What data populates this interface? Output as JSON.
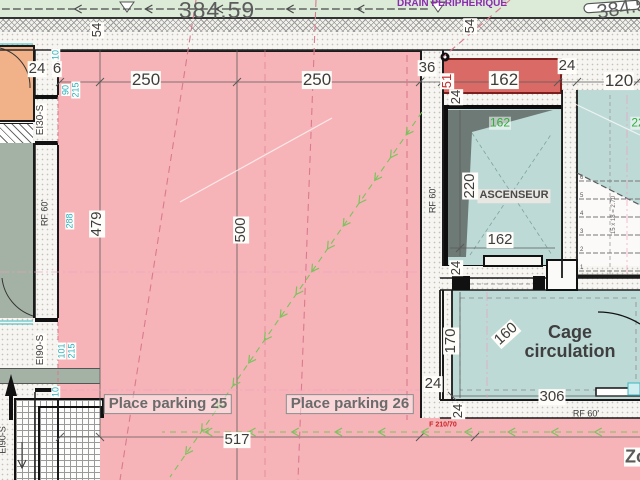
{
  "plan": {
    "levels": {
      "main": "384.59",
      "right": "384.5"
    },
    "drain_label": "DRAIN PÉRIPHÉRIQUE",
    "rooms": {
      "parking25": "Place parking 25",
      "parking26": "Place parking 26",
      "elevator": "ASCENSEUR",
      "cage": "Cage circulation",
      "zone_partial": "Zo"
    },
    "dims": {
      "d6": "6",
      "d10": "10",
      "d22": "22",
      "d24": "24",
      "d36": "36",
      "d51": "51",
      "d54": "54",
      "d90": "90",
      "d101": "101",
      "d120": "120",
      "d160": "160",
      "d162": "162",
      "d170": "170",
      "d215": "215",
      "d220": "220",
      "d250": "250",
      "d288": "288",
      "d306": "306",
      "d479": "479",
      "d500": "500",
      "d517": "517"
    },
    "labels": {
      "ei30": "EI30-S",
      "ei90": "EI90-S",
      "rf60": "RF 60'",
      "f210": "F 210/70",
      "stair_formula": "15 x 18 = 2.70"
    },
    "stairs": {
      "steps": [
        "1",
        "2",
        "3",
        "4",
        "5",
        "6"
      ]
    },
    "colors": {
      "parking_pink": "#f6b4b8",
      "room_teal": "#bedad6",
      "room_sage": "#a4b2a5",
      "room_orange": "#f2b289",
      "reserve_red": "#d96a66",
      "pit_gray": "#6e7a76",
      "dim_cyan": "#27b2c2",
      "dim_green": "#2fae3e",
      "axis_rose": "#d97a8e",
      "drain_purple": "#8a2bb0",
      "flow_green": "#7cc25e"
    }
  }
}
